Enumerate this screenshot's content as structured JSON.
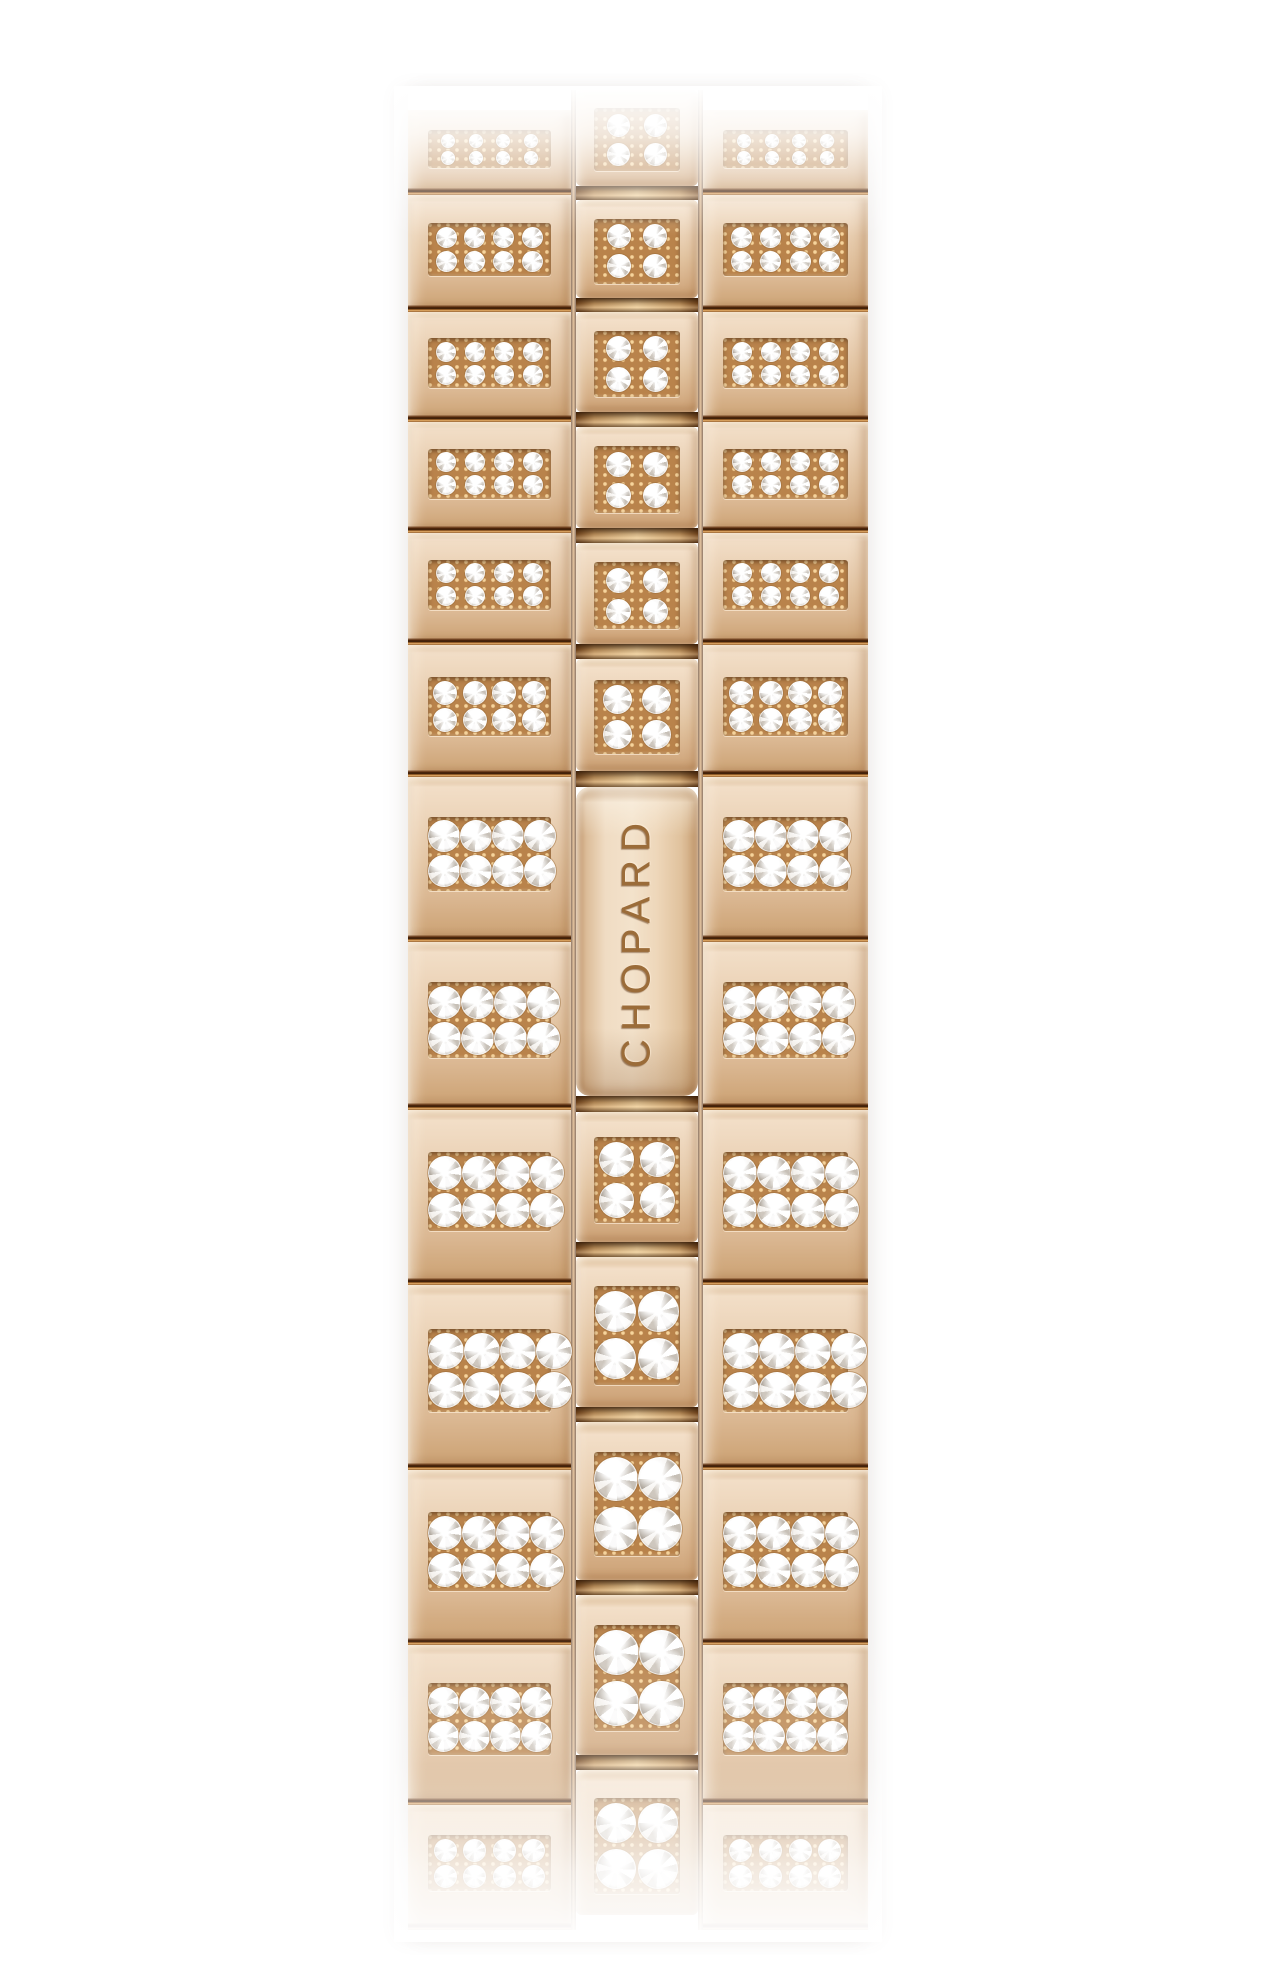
{
  "page": {
    "background_color": "#ffffff"
  },
  "product_photo": {
    "subject": "rose-gold watch bracelet fully set with diamonds",
    "brand_engraving": "CHOPARD",
    "palette": {
      "gold_highlight": "#f6e7d2",
      "gold_light": "#eed7bd",
      "gold_mid": "#e3c4a2",
      "gold_deep": "#d2ab81",
      "gold_dark": "#b98a5a",
      "seam_dark": "#40200a",
      "seam_bright": "#c08445",
      "pave_bed_gold": "#b9834b",
      "prong_gold": "#ecc78f",
      "diamond_white": "#ffffff",
      "diamond_shadow": "#b2aaa0",
      "engraving": "#9b6c39"
    },
    "bracelet": {
      "columns": [
        {
          "id": "left",
          "type": "side-links"
        },
        {
          "id": "center",
          "type": "center-links-with-clasp"
        },
        {
          "id": "right",
          "type": "side-links"
        }
      ],
      "side_link_pave": {
        "rows": 2,
        "cols": 4
      },
      "center_link_pave": {
        "rows": 2,
        "cols": 2
      },
      "geometry": {
        "left": 408,
        "top": 90,
        "width": 460,
        "height": 1848,
        "column_widths": [
          163,
          5,
          122,
          5,
          165
        ],
        "side_column_top_offset": 20,
        "side_rows": [
          85,
          117,
          110,
          111,
          112,
          132,
          165,
          168,
          175,
          185,
          175,
          160,
          125
        ],
        "side_fade_from_index": 12,
        "center_items": [
          {
            "kind": "link",
            "h": 96
          },
          {
            "kind": "connector",
            "h": 14
          },
          {
            "kind": "link",
            "h": 98
          },
          {
            "kind": "connector",
            "h": 14
          },
          {
            "kind": "link",
            "h": 100
          },
          {
            "kind": "connector",
            "h": 15
          },
          {
            "kind": "link",
            "h": 101
          },
          {
            "kind": "connector",
            "h": 15
          },
          {
            "kind": "link",
            "h": 101
          },
          {
            "kind": "connector",
            "h": 15
          },
          {
            "kind": "link",
            "h": 112
          },
          {
            "kind": "connector",
            "h": 16
          },
          {
            "kind": "clasp",
            "h": 309
          },
          {
            "kind": "connector",
            "h": 16
          },
          {
            "kind": "link",
            "h": 130
          },
          {
            "kind": "connector",
            "h": 15
          },
          {
            "kind": "link",
            "h": 150
          },
          {
            "kind": "connector",
            "h": 15
          },
          {
            "kind": "link",
            "h": 158
          },
          {
            "kind": "connector",
            "h": 15
          },
          {
            "kind": "link",
            "h": 160
          },
          {
            "kind": "connector",
            "h": 15
          },
          {
            "kind": "link",
            "h": 145,
            "fade": true
          }
        ]
      }
    }
  }
}
